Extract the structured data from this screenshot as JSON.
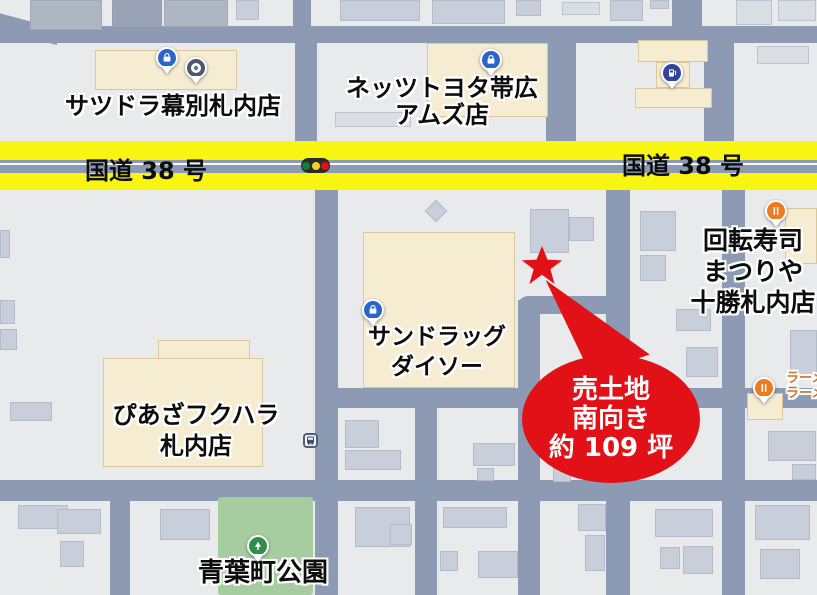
{
  "highway": {
    "label_left": "国道 38 号",
    "label_right": "国道 38 号"
  },
  "callout": {
    "line1": "売土地",
    "line2": "南向き",
    "line3": "約 109 坪"
  },
  "places": {
    "satsudora": {
      "name": "サツドラ幕別札内店"
    },
    "netz": {
      "name1": "ネッツトヨタ帯広",
      "name2": "アムズ店"
    },
    "kaitenzushi": {
      "name1": "回転寿司",
      "name2": "まつりや",
      "name3": "十勝札内店"
    },
    "sundrug": {
      "name1": "サンドラッグ",
      "name2": "ダイソー"
    },
    "piaza": {
      "name1": "ぴあざフクハラ",
      "name2": "札内店"
    },
    "park": {
      "name": "青葉町公園"
    },
    "ramen": {
      "name1": "ラーメン",
      "name2": "ラーメン"
    }
  },
  "icons": {
    "shop_pin": "shopping-bag-icon",
    "dot_pin": "dot-icon",
    "fuel_pin": "fuel-pump-icon",
    "restaurant_pin": "restaurant-icon",
    "park_pin": "tree-icon",
    "bus_stop": "bus-icon",
    "traffic_light": "traffic-light-icon",
    "property_marker": "star-icon"
  },
  "colors": {
    "road": "#8c9bb3",
    "block": "#e9eaec",
    "highway": "#f9f513",
    "accent_red": "#e21118",
    "beige": "#f6ecd2",
    "bld_gray": "#c9cfda",
    "park": "#a6cd9f",
    "pin_blue": "#2a66c8",
    "pin_navy": "#30449e",
    "pin_orange": "#ed7b21",
    "pin_green": "#2f8f46",
    "pin_gray": "#4e5868",
    "label_orange": "#cf752c"
  }
}
